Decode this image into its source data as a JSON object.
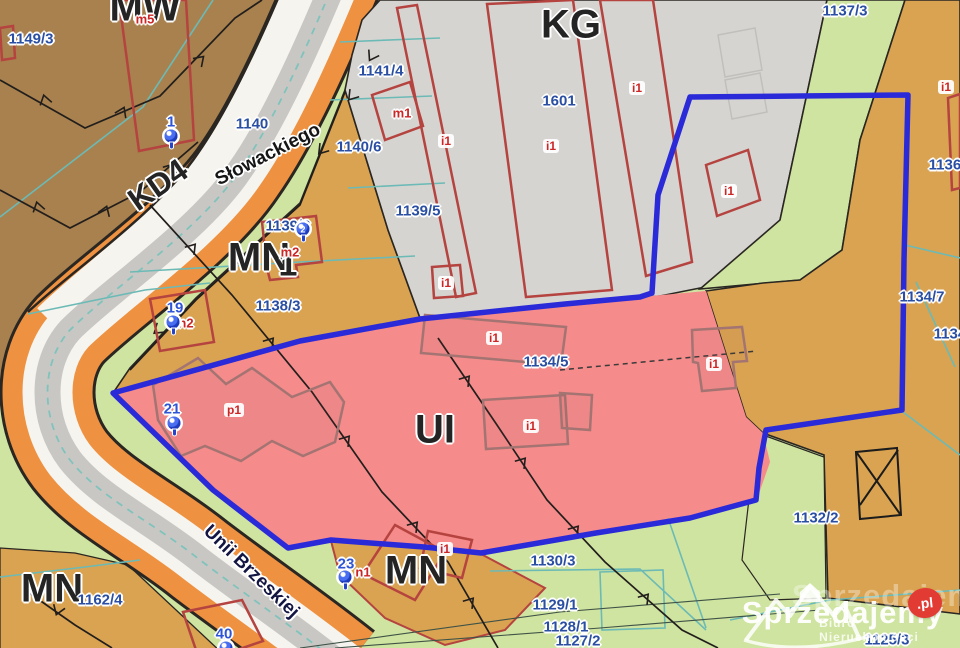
{
  "zone_labels": {
    "mw": "MW",
    "kg": "KG",
    "kd4": "KD4",
    "mn_center": "MN",
    "mn_center_suffix": "1",
    "ui": "UI",
    "mn_south": "MN",
    "mn_southwest": "MN"
  },
  "street_labels": {
    "slowackiego": "Słowackiego",
    "unii_brzeskiej": "Unii Brzeskiej"
  },
  "parcel_numbers": {
    "p1149_3": "1149/3",
    "p1141_4": "1141/4",
    "p1140_6": "1140/6",
    "p1139_5": "1139/5",
    "p1140": "1140",
    "p1601": "1601",
    "p1137_3": "1137/3",
    "p1136": "1136/",
    "p1139_3": "1139/3",
    "p1138_3": "1138/3",
    "p1134_5": "1134/5",
    "p1134_7": "1134/7",
    "p1134": "1134/",
    "p1132_2": "1132/2",
    "p1130_3": "1130/3",
    "p1129_1": "1129/1",
    "p1128_1": "1128/1",
    "p1127_2": "1127/2",
    "p1125_3": "1125/3",
    "p1162_4": "1162/4"
  },
  "building_labels": {
    "m5": "m5",
    "m1": "m1",
    "m2": "m2",
    "n2": "n2",
    "n1": "n1",
    "p1": "p1",
    "i1": "i1"
  },
  "markers": {
    "m1": "1",
    "m2": "2",
    "m19": "19",
    "m21": "21",
    "m23": "23",
    "m40": "40"
  },
  "watermark": {
    "brand": "Sprzedajemy",
    "brand_ghost": "Sprzedajemy",
    "tld": ".pl",
    "tagline": "Biuro Nieruchomości"
  },
  "colors": {
    "boundary_blue": "#2a2ad8",
    "zone_pink": "#f58b8b",
    "zone_gray": "#d6d4d1",
    "zone_tan": "#d9a351",
    "zone_brown": "#a8814e",
    "zone_green": "#cfe4a0",
    "road_orange": "#ee9140",
    "building_red": "#b5433f",
    "parcel_text": "#2a4fa2",
    "marker_blue": "#2e55d6",
    "label_red": "#cc2525"
  }
}
